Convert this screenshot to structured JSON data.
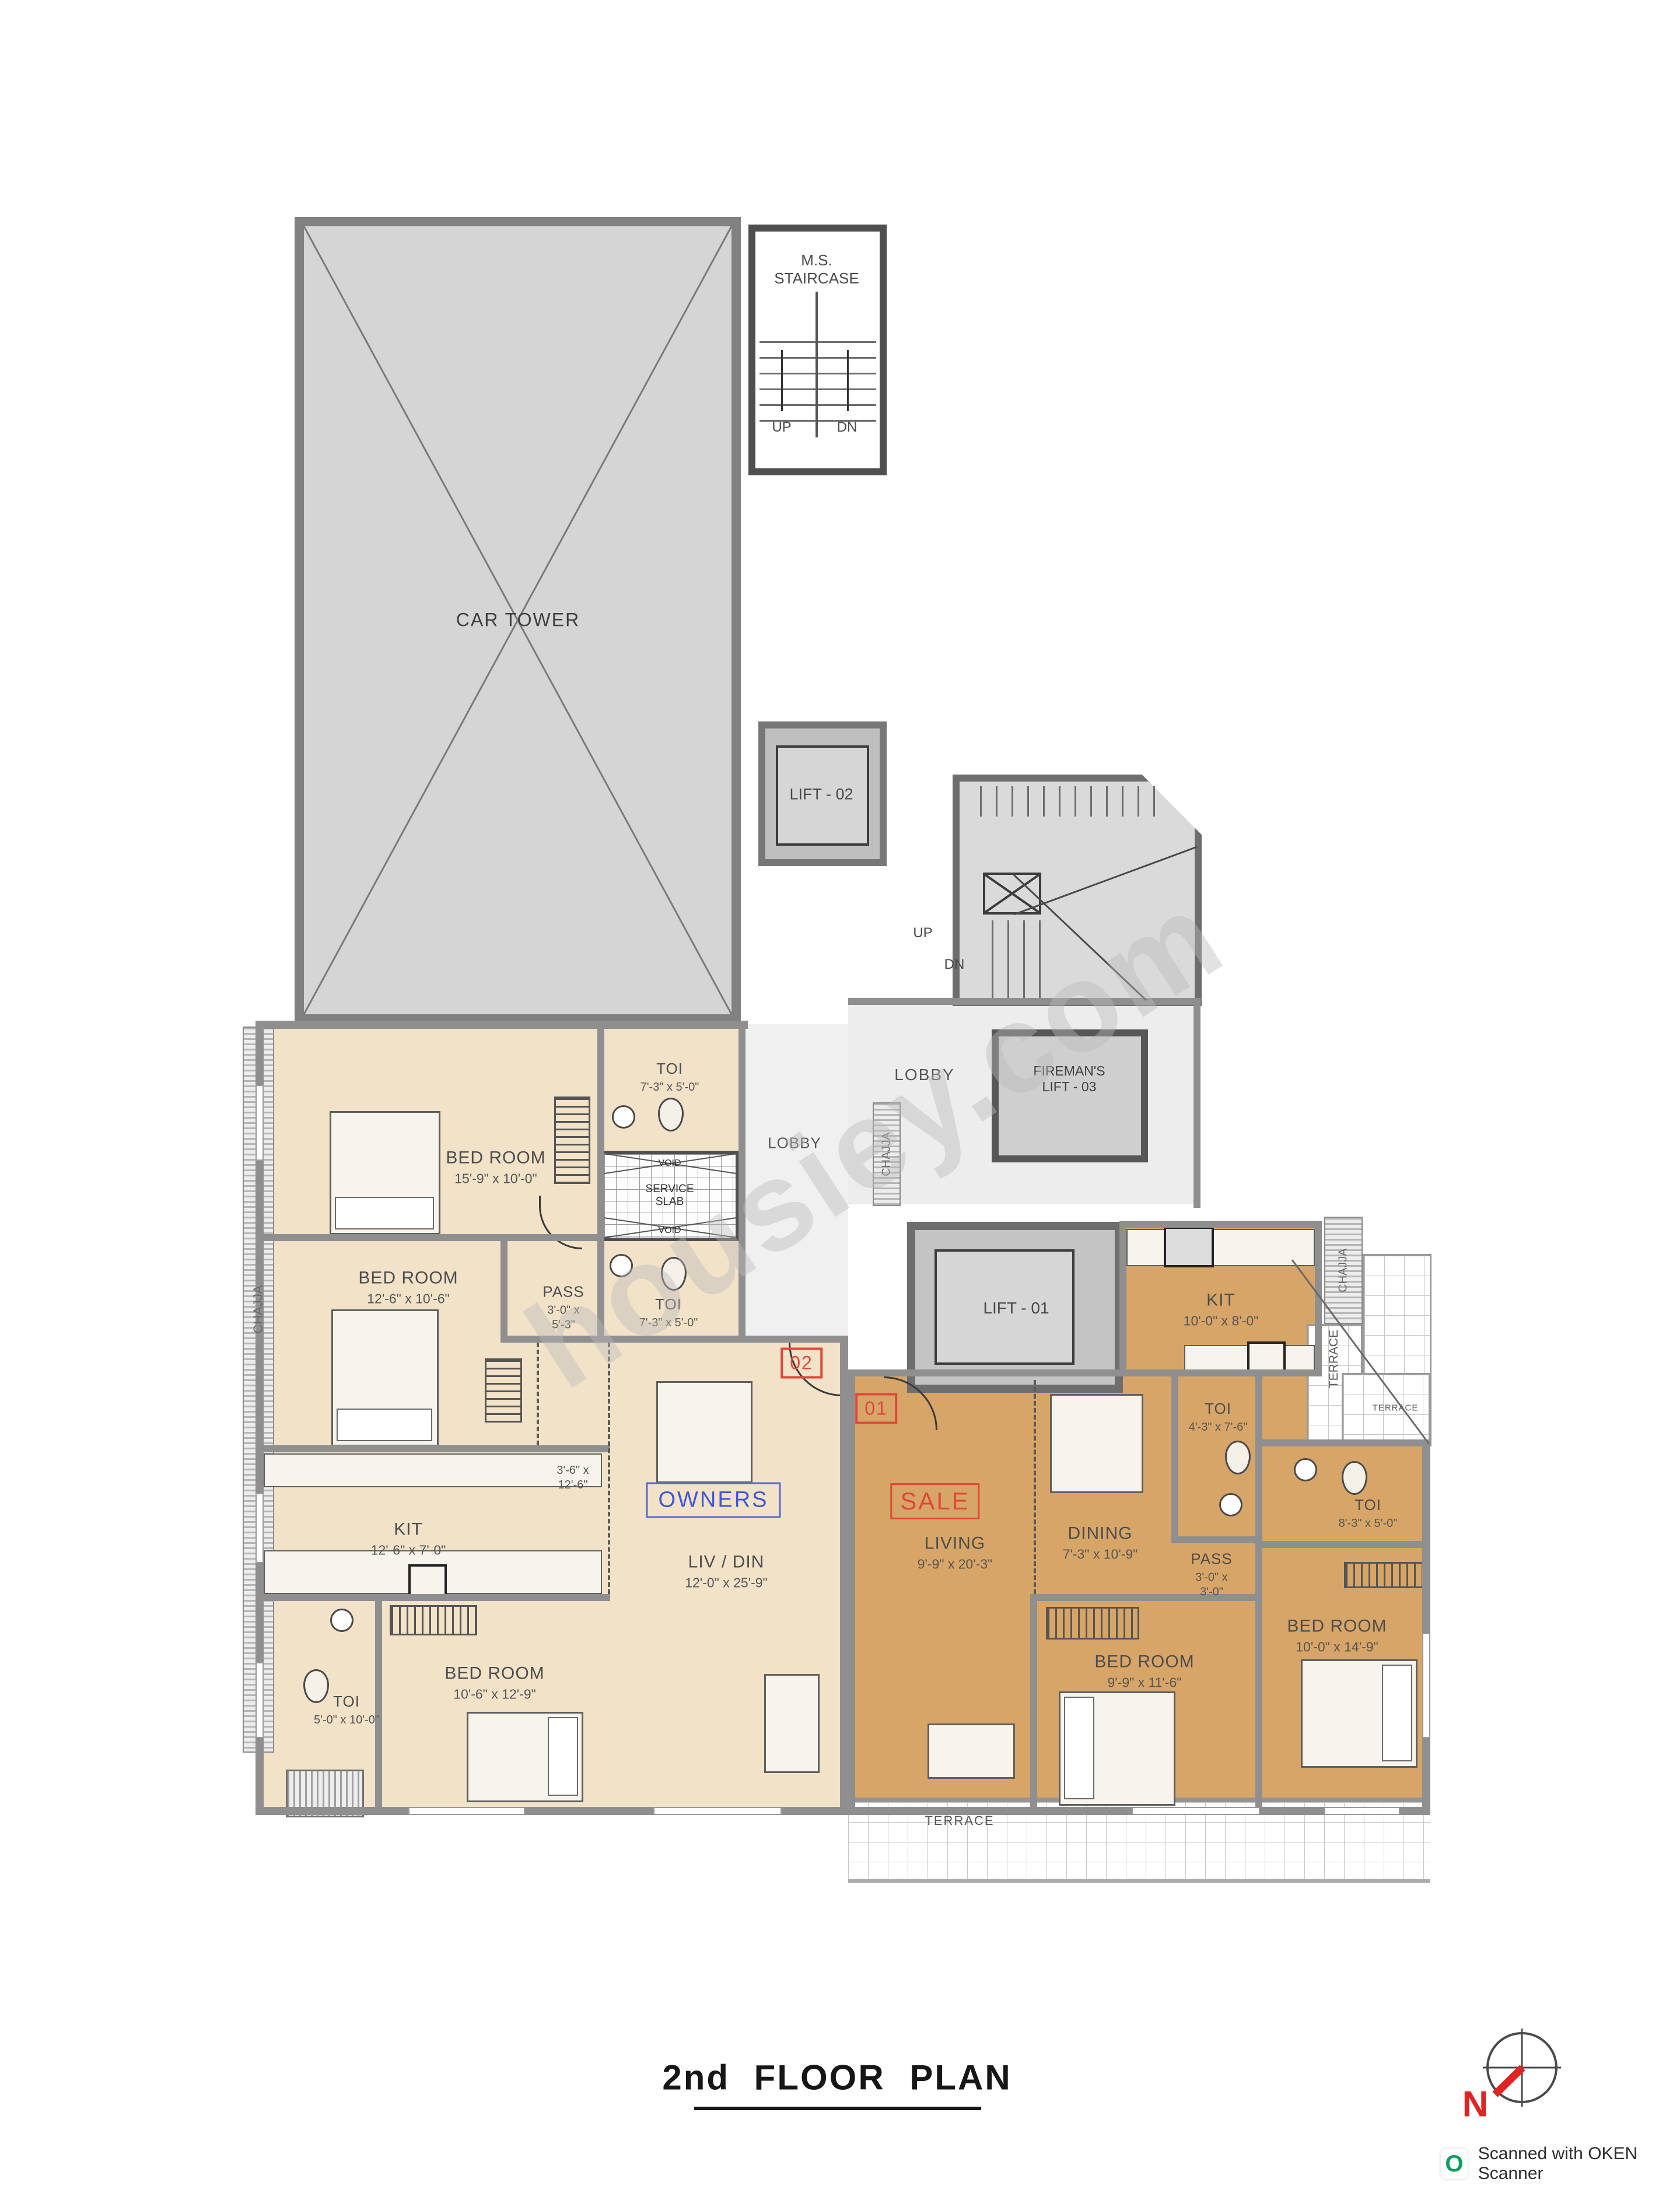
{
  "title": "2nd  FLOOR  PLAN",
  "watermark": "housiey.com",
  "compass": {
    "north": "N"
  },
  "footer": {
    "scanner_icon": "O",
    "scanner_text": "Scanned with OKEN Scanner"
  },
  "core": {
    "car_tower": "CAR TOWER",
    "staircase_line1": "M.S.",
    "staircase_line2": "STAIRCASE",
    "up": "UP",
    "dn": "DN",
    "stair_up": "UP",
    "stair_dn": "DN",
    "lift1": "LIFT - 01",
    "lift2": "LIFT - 02",
    "fireman_line1": "FIREMAN'S",
    "fireman_line2": "LIFT - 03",
    "lobby_main": "LOBBY",
    "lobby_core": "LOBBY",
    "void_top": "VOID",
    "service_line1": "SERVICE",
    "service_line2": "SLAB",
    "void_bottom": "VOID"
  },
  "chajja": {
    "left": "CHAJJA",
    "core": "CHAJJA",
    "right": "CHAJJA"
  },
  "terrace": {
    "right_vertical": "TERRACE",
    "right_small": "TERRACE",
    "bottom": "TERRACE"
  },
  "unit02": {
    "badge": "02",
    "tag": "OWNERS",
    "bedroom1": {
      "name": "BED ROOM",
      "dims": "15'-9\" x 10'-0\""
    },
    "toi1": {
      "name": "TOI",
      "dims": "7'-3\" x 5'-0\""
    },
    "bedroom2": {
      "name": "BED ROOM",
      "dims": "12'-6\" x 10'-6\""
    },
    "pass": {
      "name": "PASS",
      "dims": "3'-0\" x\n5'-3\""
    },
    "toi2": {
      "name": "TOI",
      "dims": "7'-3\" x 5'-0\""
    },
    "kitchen": {
      "name": "KIT",
      "dims": "12'-6\" x 7'-0\""
    },
    "passage_dims": "3'-6\" x\n12'-6\"",
    "livdin": {
      "name": "LIV / DIN",
      "dims": "12'-0\" x 25'-9\""
    },
    "bedroom3": {
      "name": "BED ROOM",
      "dims": "10'-6\" x 12'-9\""
    },
    "toi3": {
      "name": "TOI",
      "dims": "5'-0\" x 10'-0\""
    }
  },
  "unit01": {
    "badge": "01",
    "tag": "SALE",
    "kitchen": {
      "name": "KIT",
      "dims": "10'-0\" x 8'-0\""
    },
    "toi1": {
      "name": "TOI",
      "dims": "4'-3\" x 7'-6\""
    },
    "toi2": {
      "name": "TOI",
      "dims": "8'-3\" x 5'-0\""
    },
    "pass": {
      "name": "PASS",
      "dims": "3'-0\" x\n3'-0\""
    },
    "living": {
      "name": "LIVING",
      "dims": "9'-9\" x 20'-3\""
    },
    "dining": {
      "name": "DINING",
      "dims": "7'-3\" x 10'-9\""
    },
    "bedroom1": {
      "name": "BED ROOM",
      "dims": "9'-9\" x 11'-6\""
    },
    "bedroom2": {
      "name": "BED ROOM",
      "dims": "10'-0\" x 14'-9\""
    }
  },
  "colors": {
    "unit02_fill": "#f1e2c8",
    "unit01_fill": "#d7a567",
    "accent_red": "#e0483a",
    "accent_blue": "#4055d8",
    "structure_grey": "#d5d5d5"
  }
}
